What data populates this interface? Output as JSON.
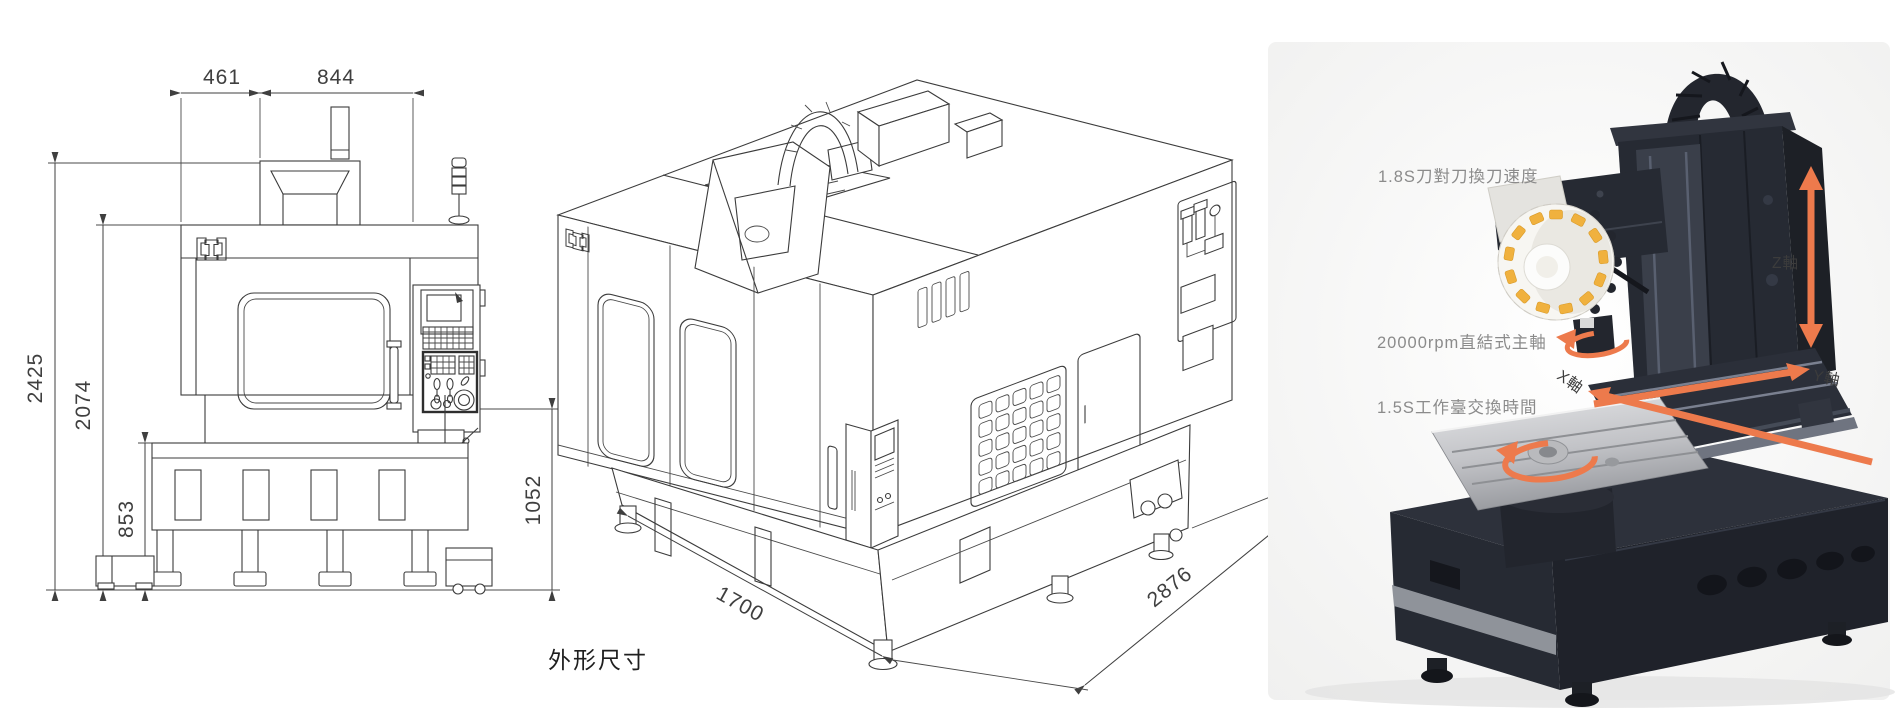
{
  "front_view": {
    "dim_top_left": "461",
    "dim_top_right": "844",
    "dim_overall_height": "2425",
    "dim_body_height": "2074",
    "dim_base_height": "853",
    "dim_panel_height": "1052"
  },
  "iso_view": {
    "dim_depth": "1700",
    "dim_width": "2876",
    "caption": "外形尺寸"
  },
  "photo": {
    "callout_tool_change": "1.8S刀對刀換刀速度",
    "callout_spindle": "20000rpm直結式主軸",
    "callout_table_change": "1.5S工作臺交換時間",
    "axis_z": "Z軸",
    "axis_y": "Y軸",
    "axis_x": "X軸",
    "arrow_color": "#ED7A4C",
    "machine_color": "#262A33",
    "tool_tag_color": "#F0B13E"
  }
}
